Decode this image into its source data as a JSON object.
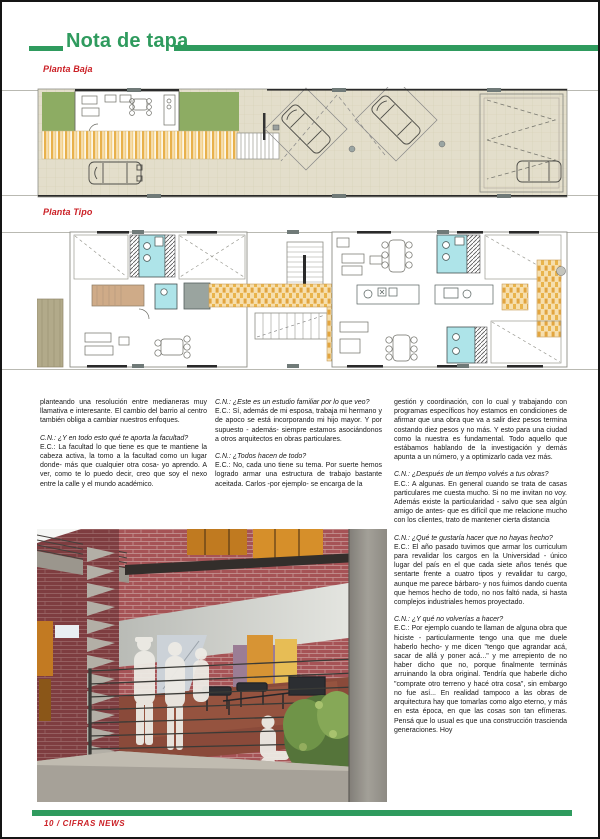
{
  "header": {
    "title": "Nota de tapa"
  },
  "plans": [
    {
      "label": "Planta Baja"
    },
    {
      "label": "Planta Tipo"
    }
  ],
  "columns": [
    {
      "blocks": [
        {
          "type": "body",
          "text": "planteando una resolución entre medianeras muy llamativa e interesante. El cambio del barrio al centro también obliga a cambiar nuestros enfoques."
        },
        {
          "type": "question",
          "text": "C.N.: ¿Y en todo esto qué te aporta la facultad?"
        },
        {
          "type": "answer",
          "text": "E.C.: La facultad lo que tiene es que te mantiene la cabeza activa, la tomo a la facultad como un lugar donde- más que cualquier otra cosa- yo aprendo. A ver, como te lo puedo decir, creo que soy el nexo entre la calle y el mundo académico."
        }
      ]
    },
    {
      "blocks": [
        {
          "type": "question",
          "text": "C.N.: ¿Este es un estudio familiar por lo que veo?"
        },
        {
          "type": "answer",
          "text": "E.C.: Sí, además de mi esposa, trabaja mi hermano y de apoco se está incorporando mi hijo mayor. Y por supuesto - además- siempre estamos asociándonos a otros arquitectos en obras particulares."
        },
        {
          "type": "question",
          "text": "C.N.: ¿Todos hacen de todo?"
        },
        {
          "type": "answer",
          "text": "E.C.: No, cada uno tiene su tema. Por suerte hemos logrado armar una estructura de trabajo bastante aceitada. Carlos -por ejemplo- se encarga de la"
        }
      ]
    },
    {
      "blocks": [
        {
          "type": "answer",
          "text": "gestión y coordinación, con lo cual y trabajando con programas específicos hoy estamos en condiciones de afirmar que una obra que va a salir diez pesos termina costando diez pesos y no más. Y esto para una ciudad como la nuestra es fundamental. Todo aquello que estábamos hablando de la investigación y demás apunta a un número, y a optimizarlo cada vez más."
        },
        {
          "type": "question",
          "text": "C.N.: ¿Después de un tiempo volvés a tus obras?"
        },
        {
          "type": "answer",
          "text": "E.C.: A algunas. En general cuando se trata de casas particulares me cuesta mucho. Si no me invitan no voy. Además existe la particularidad - salvo que sea algún amigo de antes- que es difícil que me relacione mucho con los clientes, trato de mantener cierta distancia"
        },
        {
          "type": "question",
          "text": "C.N.: ¿Qué te gustaría hacer que no hayas hecho?"
        },
        {
          "type": "answer",
          "text": "E.C.: El año pasado tuvimos que armar los curriculum para revalidar los cargos en la Universidad - único lugar del país en el que cada siete años tenés que sentarte frente a cuatro tipos y revalidar tu cargo, aunque me parece bárbaro- y nos fuimos dando cuenta que hemos hecho de todo, no nos faltó nada, si hasta complejos industriales hemos proyectado."
        },
        {
          "type": "question",
          "text": "C.N.: ¿Y qué no volverías a hacer?"
        },
        {
          "type": "answer",
          "text": "E.C.: Por ejemplo cuando te llaman de alguna obra que hiciste - particularmente tengo una que me duele haberlo hecho- y me dicen \"tengo que agrandar acá, sacar de allá y poner acá...\" y me arrepiento de no haber dicho que no, porque finalmente terminás arruinando la obra original. Tendría que haberle dicho \"comprate otro terreno y hacé otra cosa\", sin embargo no fue así... En realidad tampoco a las obras de arquitectura hay que tomarlas como algo eterno, y más en esta época, en que las cosas son tan efímeras. Pensá que lo usual es que una construcción trascienda generaciones. Hoy"
        }
      ]
    }
  ],
  "footer": {
    "page_label": "10  /  CIFRAS NEWS"
  },
  "colors": {
    "accent_green": "#2f9b5e",
    "label_red": "#cb2026",
    "plan_grass": "#8dac63",
    "plan_deck": "#e8b14b",
    "plan_pavement": "#e3decb",
    "plan_bath": "#aee4e9",
    "plan_tile": "#e9b44c",
    "plan_wood": "#cfab88",
    "photo_brick": "#a65356",
    "photo_concrete": "#9b968d"
  }
}
